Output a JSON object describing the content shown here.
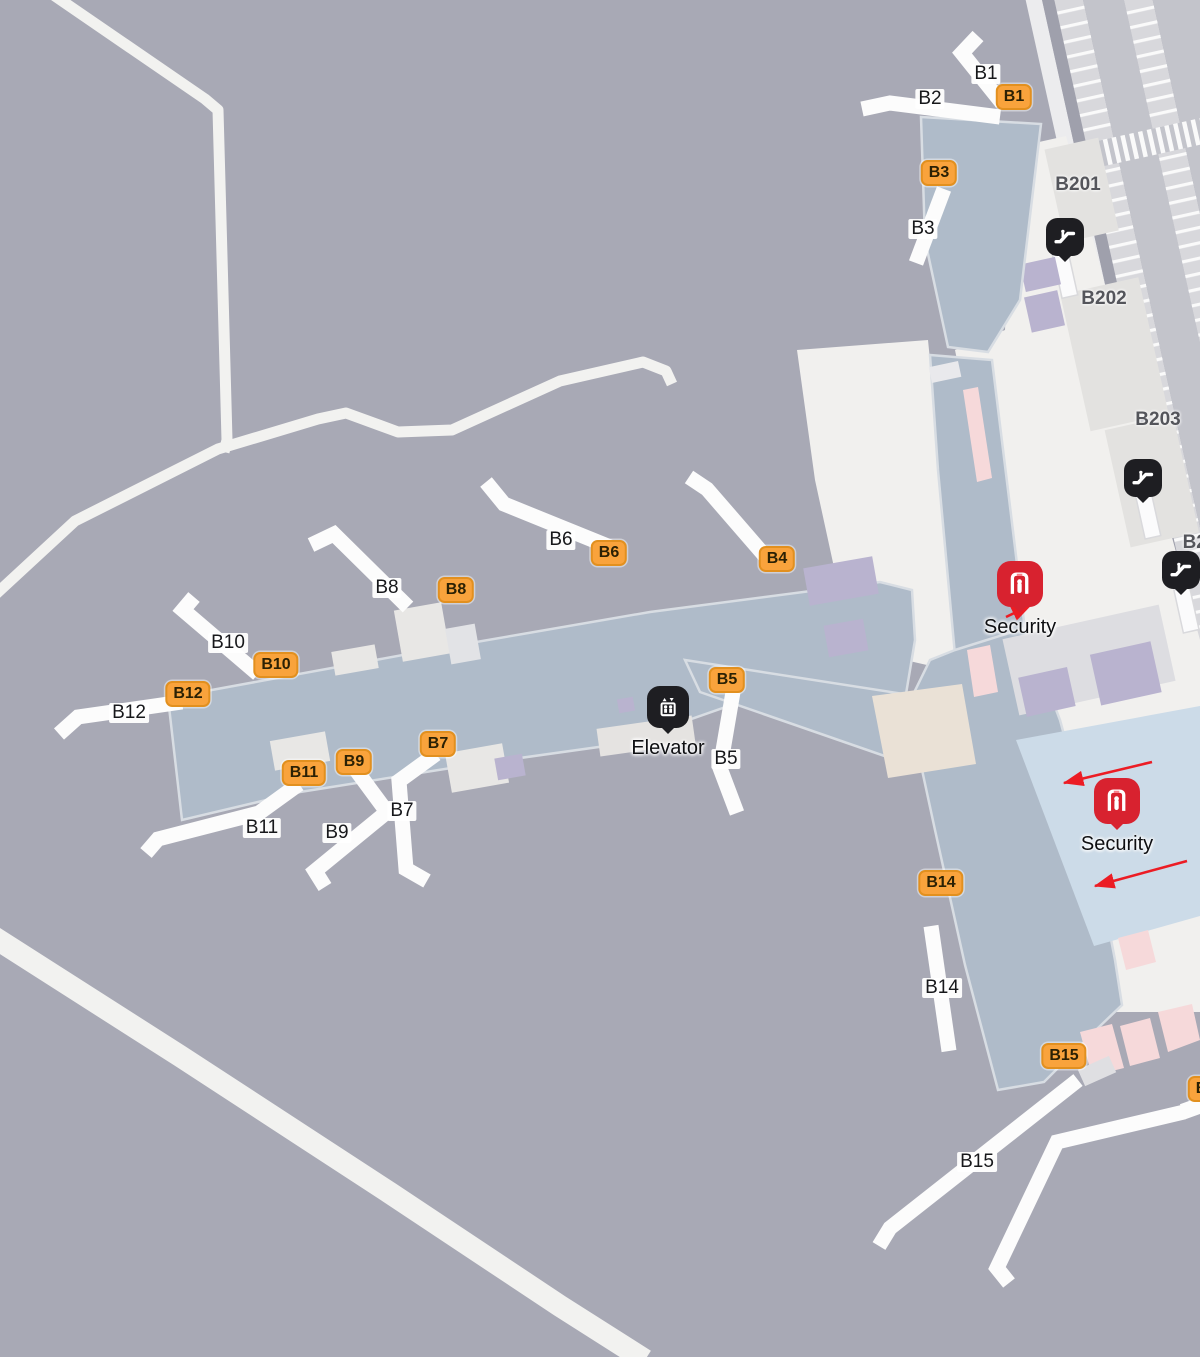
{
  "map": {
    "kind": "airport-terminal-gate-map",
    "colors": {
      "background": "#a8a9b5",
      "terminal": "#afbbc9",
      "building": "#f1f0ee",
      "badge_fill": "#f9a33c",
      "badge_border": "#e2901f",
      "badge_text": "#2b2104",
      "security_red": "#d8222f",
      "icon_black": "#1e1e22",
      "arrow_red": "#ec1c24",
      "area_label_gray": "#54555b",
      "security_zone_blue": "#ccdbe8"
    },
    "gates": [
      {
        "label": "B1",
        "x": 1014,
        "y": 97
      },
      {
        "label": "B3",
        "x": 939,
        "y": 173
      },
      {
        "label": "B4",
        "x": 777,
        "y": 559
      },
      {
        "label": "B6",
        "x": 609,
        "y": 553
      },
      {
        "label": "B8",
        "x": 456,
        "y": 590
      },
      {
        "label": "B10",
        "x": 276,
        "y": 665
      },
      {
        "label": "B12",
        "x": 188,
        "y": 694
      },
      {
        "label": "B5",
        "x": 727,
        "y": 680
      },
      {
        "label": "B7",
        "x": 438,
        "y": 744
      },
      {
        "label": "B9",
        "x": 354,
        "y": 762
      },
      {
        "label": "B11",
        "x": 304,
        "y": 773
      },
      {
        "label": "B14",
        "x": 941,
        "y": 883
      },
      {
        "label": "B15",
        "x": 1064,
        "y": 1056
      },
      {
        "label": "B1",
        "x": 1206,
        "y": 1089
      }
    ],
    "bridge_labels": [
      {
        "label": "B1",
        "x": 986,
        "y": 74
      },
      {
        "label": "B2",
        "x": 930,
        "y": 99
      },
      {
        "label": "B3",
        "x": 923,
        "y": 229
      },
      {
        "label": "B6",
        "x": 561,
        "y": 540
      },
      {
        "label": "B8",
        "x": 387,
        "y": 588
      },
      {
        "label": "B10",
        "x": 228,
        "y": 643
      },
      {
        "label": "B12",
        "x": 129,
        "y": 713
      },
      {
        "label": "B7",
        "x": 402,
        "y": 811
      },
      {
        "label": "B9",
        "x": 337,
        "y": 833
      },
      {
        "label": "B11",
        "x": 262,
        "y": 828
      },
      {
        "label": "B5",
        "x": 726,
        "y": 759
      },
      {
        "label": "B14",
        "x": 942,
        "y": 988
      },
      {
        "label": "B15",
        "x": 977,
        "y": 1162
      }
    ],
    "area_labels": [
      {
        "label": "B201",
        "x": 1078,
        "y": 185
      },
      {
        "label": "B202",
        "x": 1104,
        "y": 299
      },
      {
        "label": "B203",
        "x": 1158,
        "y": 420
      },
      {
        "label": "B20",
        "x": 1200,
        "y": 543
      }
    ],
    "poi": [
      {
        "type": "escalator",
        "label": "",
        "x": 1065,
        "y": 237
      },
      {
        "type": "escalator",
        "label": "",
        "x": 1143,
        "y": 478
      },
      {
        "type": "escalator",
        "label": "",
        "x": 1181,
        "y": 570
      },
      {
        "type": "elevator",
        "label": "Elevator",
        "x": 668,
        "y": 707
      },
      {
        "type": "security",
        "label": "Security",
        "x": 1020,
        "y": 584
      },
      {
        "type": "security",
        "label": "Security",
        "x": 1117,
        "y": 801
      }
    ],
    "arrows": [
      {
        "x1": 1006,
        "y1": 617,
        "x2": 1031,
        "y2": 605
      },
      {
        "x1": 1152,
        "y1": 762,
        "x2": 1064,
        "y2": 783
      },
      {
        "x1": 1187,
        "y1": 861,
        "x2": 1095,
        "y2": 886
      }
    ]
  }
}
